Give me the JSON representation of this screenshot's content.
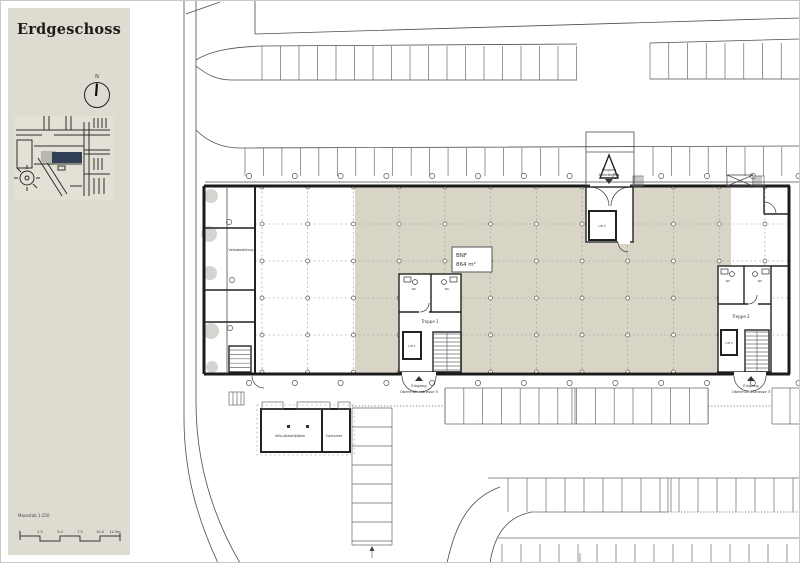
{
  "sidebar": {
    "title": "Erdgeschoss",
    "north_label": "N",
    "scale_label": "Massstab 1:250",
    "scale_ticks": [
      "0",
      "2.5",
      "5.0",
      "7.5",
      "10.0",
      "12.5m"
    ]
  },
  "plan": {
    "area_box": {
      "label": "BNF",
      "value": "864 m²"
    },
    "labels": {
      "entrance_top_1": "Eingang",
      "entrance_top_2": "Anlieferung",
      "entrance_sw_1": "Eingang",
      "entrance_sw_2": "Obermühlestrasse 5",
      "entrance_se_1": "Eingang",
      "entrance_se_2": "Obermühlestrasse 3",
      "stair_1": "Treppe 1",
      "stair_2": "Treppe 2",
      "lift_1": "Lift 1",
      "lift_2": "Lift 2",
      "lift_3": "Lift 3",
      "bike_room": "Veloabstellung",
      "shed_bikes": "Velo-Abstellplätze",
      "shed_container": "Container",
      "wc": "WC"
    },
    "colors": {
      "sidebar_bg": "#dedbd0",
      "tenant_area": "#d9d5c6",
      "map_building": "#333e57",
      "line": "#4d4d4d"
    }
  }
}
